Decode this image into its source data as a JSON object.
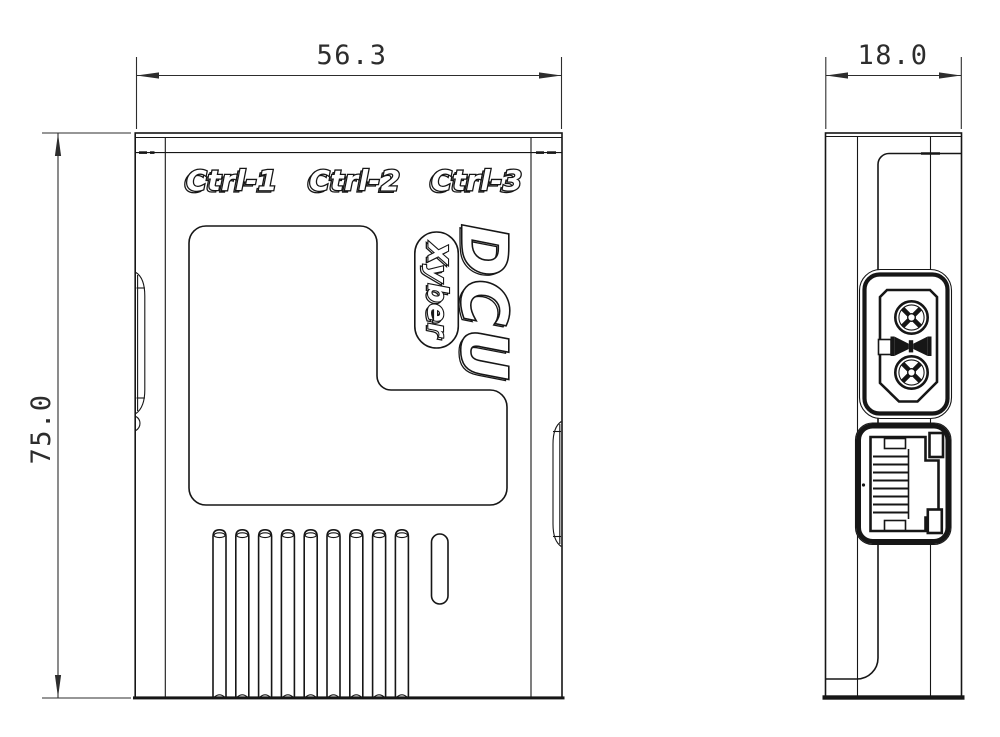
{
  "drawing": {
    "front_view": {
      "width_dim": "56.3",
      "height_dim": "75.0",
      "port_labels": {
        "ctrl1": "Ctrl-1",
        "ctrl2": "Ctrl-2",
        "ctrl3": "Ctrl-3"
      },
      "model": "DCU",
      "brand": "Xyber"
    },
    "side_view": {
      "depth_dim": "18.0"
    }
  },
  "colors": {
    "line": "#161616",
    "dim": "#2d2d2d",
    "bg": "#ffffff"
  }
}
